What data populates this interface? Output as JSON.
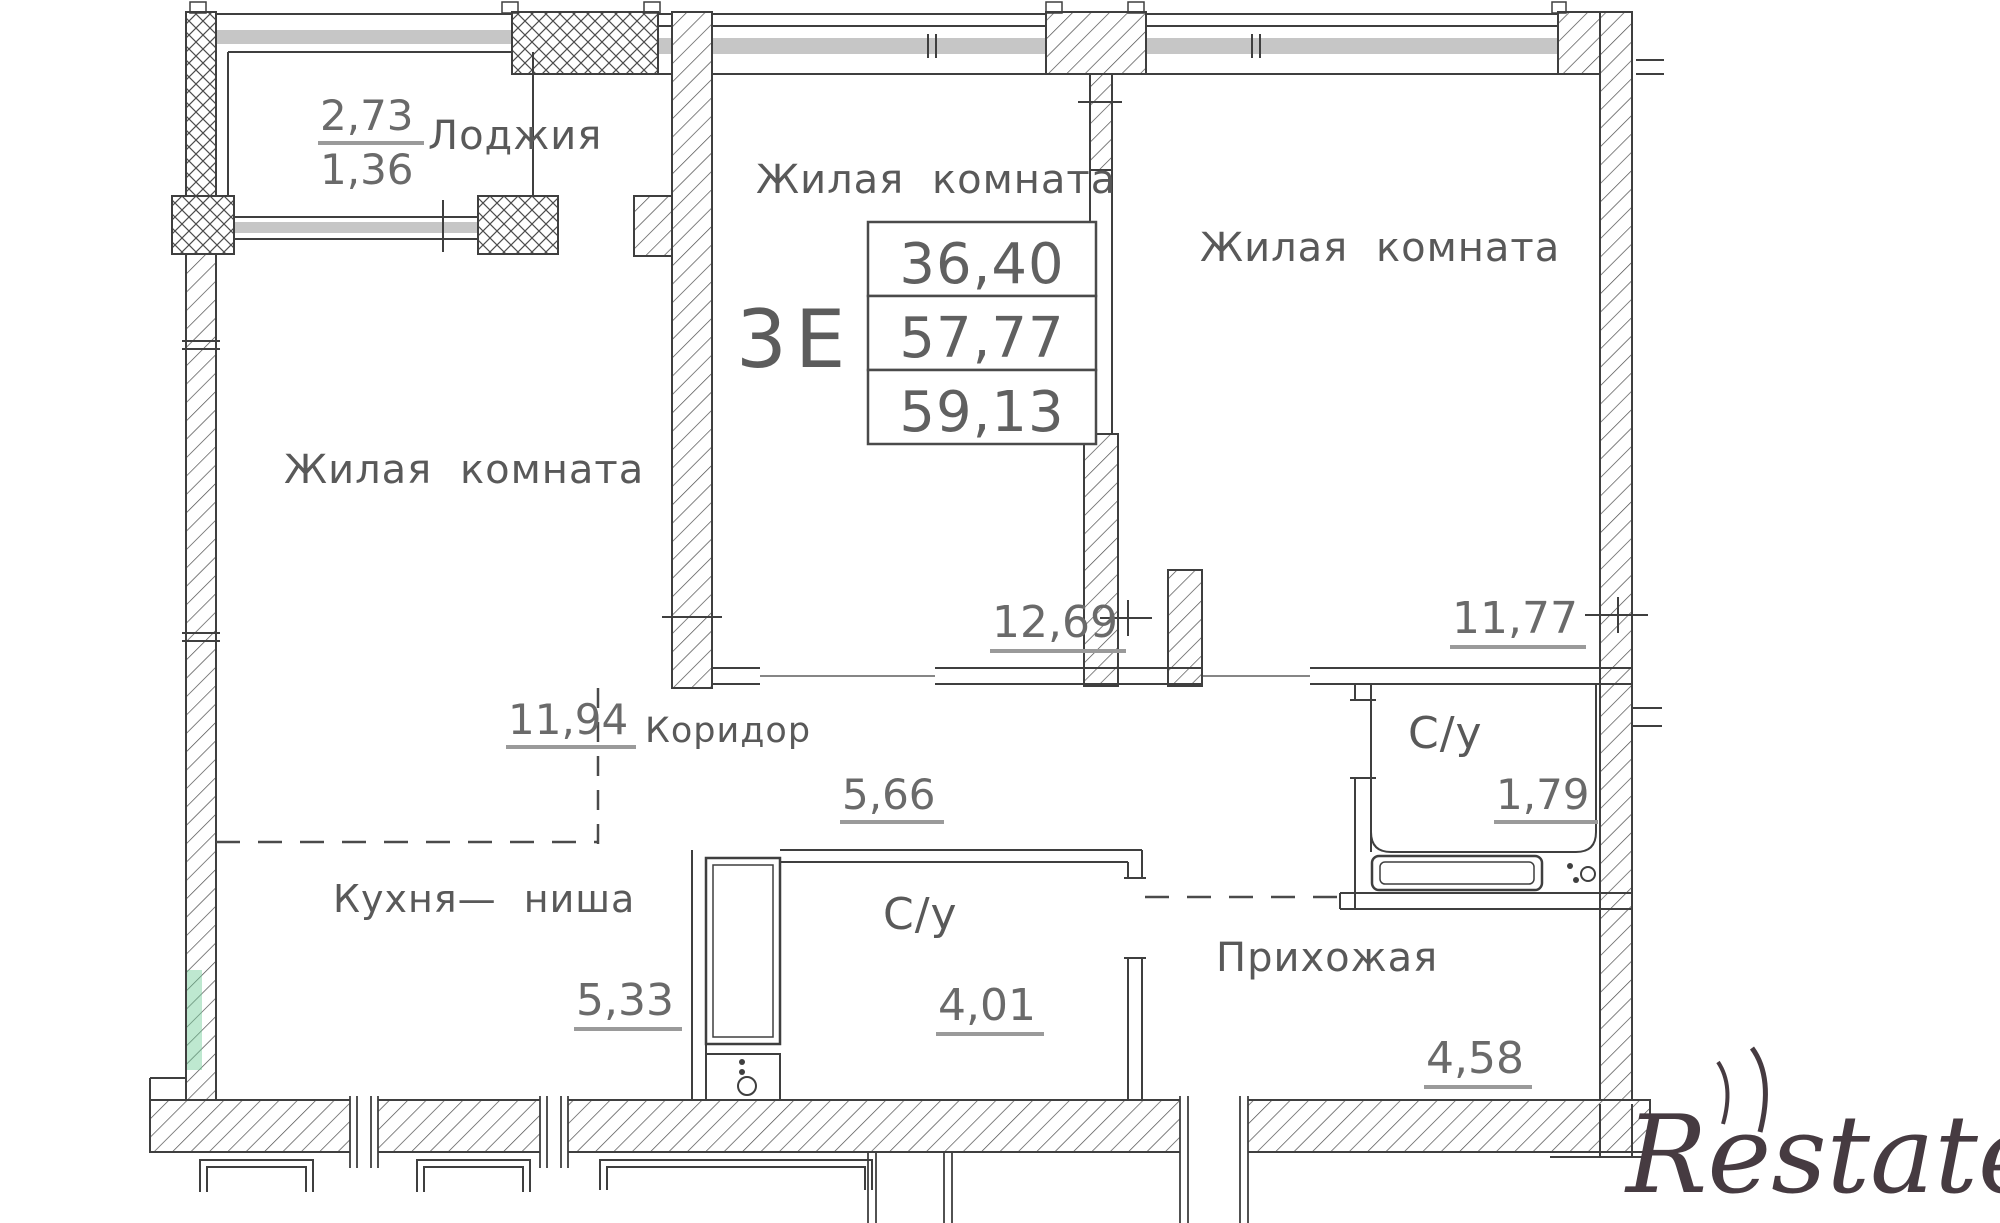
{
  "unit": {
    "type": "3Е",
    "living_area": "36,40",
    "floor_area": "57,77",
    "total_area": "59,13"
  },
  "rooms": {
    "loggia": {
      "name": "Лоджия",
      "area_full": "2,73",
      "area_reduced": "1,36"
    },
    "living_left": {
      "name": "Жилая комната",
      "area": "11,94"
    },
    "living_center": {
      "name": "Жилая комната",
      "area": "12,69"
    },
    "living_right": {
      "name": "Жилая комната",
      "area": "11,77"
    },
    "corridor": {
      "name": "Коридор",
      "area": "5,66"
    },
    "bathroom_small": {
      "name": "С/у",
      "area": "1,79"
    },
    "bathroom_main": {
      "name": "С/у",
      "area": "4,01"
    },
    "kitchen_niche": {
      "name": "Кухня— ниша",
      "area": "5,33"
    },
    "hallway": {
      "name": "Прихожая",
      "area": "4,58"
    }
  },
  "watermark": {
    "text": "Restate"
  },
  "colors": {
    "line": "#3f3f3f",
    "label_text": "#595959",
    "dim_text": "#6a6a6a",
    "window_band": "#c6c6c6",
    "wall_highlight": "#6ecd96",
    "watermark": "#463b41"
  }
}
